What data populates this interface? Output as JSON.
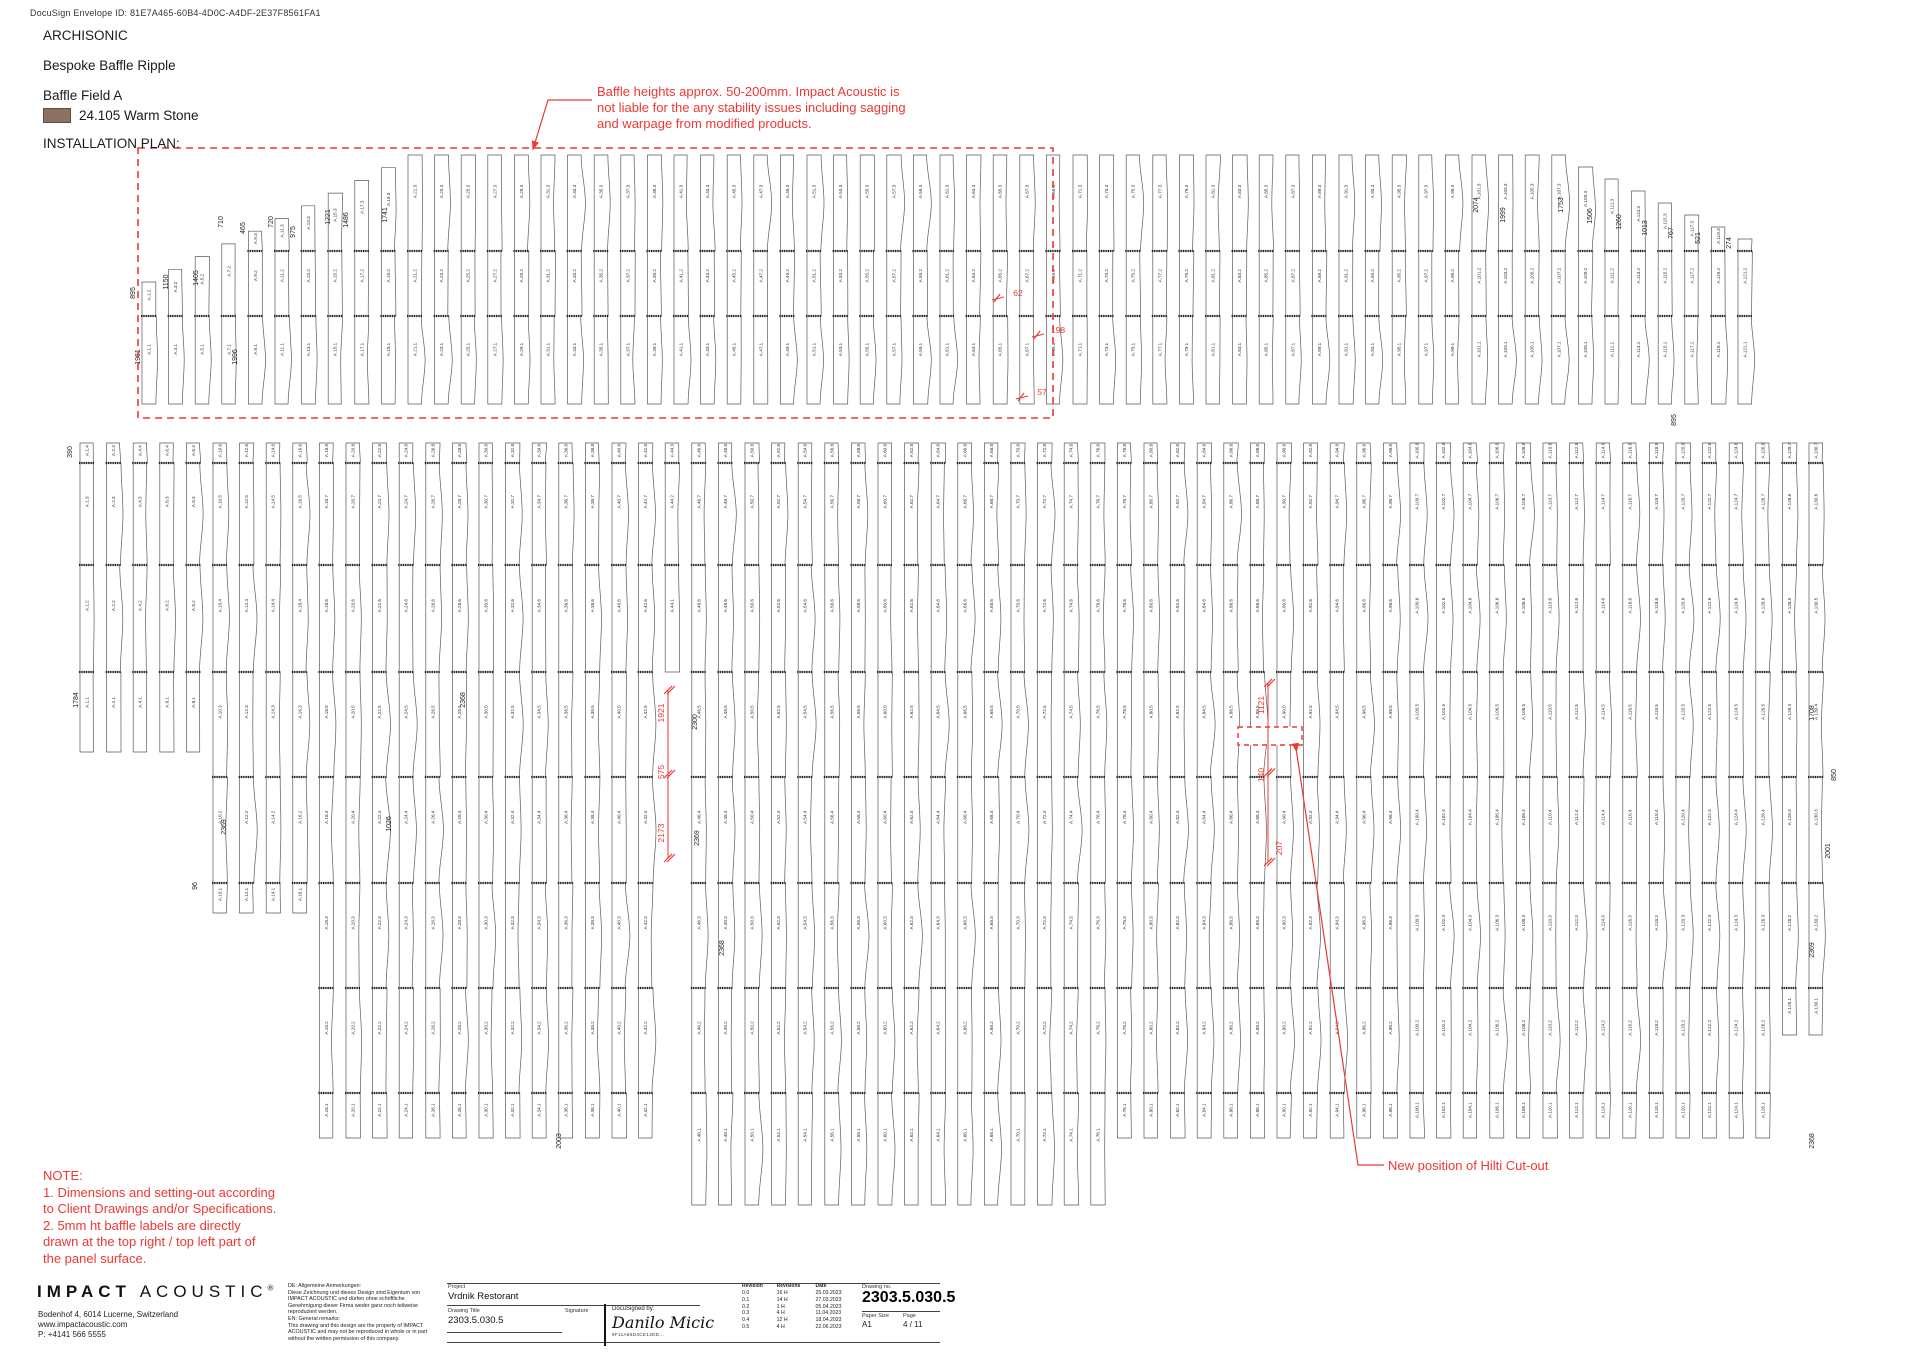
{
  "docusign_line": "DocuSign Envelope ID: 81E7A465-60B4-4D0C-A4DF-2E37F8561FA1",
  "header": {
    "brand": "ARCHISONIC",
    "product": "Bespoke Baffle Ripple",
    "field": "Baffle Field A",
    "material": "24.105 Warm Stone",
    "material_swatch_color": "#8b7160",
    "plan_label": "INSTALLATION PLAN:"
  },
  "annotations": {
    "red_color": "#ed3833",
    "baffle_note_line1": "Baffle heights approx. 50-200mm. Impact Acoustic is",
    "baffle_note_line2": "not liable for the any stability issues including sagging",
    "baffle_note_line3": "and warpage from modified products.",
    "hilti_note": "New position of Hilti Cut-out",
    "note_title": "NOTE:",
    "note_line1": "1. Dimensions and setting-out according",
    "note_line2": "to Client Drawings and/or Specifications.",
    "note_line3": "2. 5mm ht baffle labels are directly",
    "note_line4": "drawn at the top right / top left part of",
    "note_line5": "the panel surface."
  },
  "title_block": {
    "logo_bold": "IMPACT",
    "logo_light": "ACOUSTIC",
    "logo_reg": "®",
    "address_line1": "Bodenhof 4, 6014 Lucerne, Switzerland",
    "address_line2": "www.impactacoustic.com",
    "address_line3": "P: +4141 566 5555",
    "remarks_line1": "DE: Allgemeine Anmerkungen:",
    "remarks_line2": "Diese Zeichnung und dieses Design sind Eigentum von",
    "remarks_line3": "IMPACT ACOUSTIC und dürfen ohne schriftliche",
    "remarks_line4": "Genehmigung dieser Firma weder ganz noch teilweise",
    "remarks_line5": "reproduziert werden.",
    "remarks_line6": "EN: General remarks:",
    "remarks_line7": "This drawing and this design are the property of IMPACT",
    "remarks_line8": "ACOUSTIC and may not be reproduced in whole or in part",
    "remarks_line9": "without the written permission of this company.",
    "project_label": "Project",
    "project_value": "Vrdnik Restorant",
    "drawing_title_label": "Drawing Title",
    "drawing_title_value": "2303.5.030.5",
    "signature_label": "Signature",
    "docusigned_label": "DocuSigned by:",
    "docusigned_name": "Danilo Micic",
    "docusigned_id": "9F11A86D4CE14DD...",
    "revisions": {
      "headers": [
        "Revision",
        "Revisions",
        "Date"
      ],
      "rows": [
        [
          "0.0",
          "16 H",
          "25.03.2023"
        ],
        [
          "0.1",
          "14 H",
          "27.03.2023"
        ],
        [
          "0.2",
          "1 H",
          "05.04.2023"
        ],
        [
          "0.3",
          "4 H",
          "11.04.2023"
        ],
        [
          "0.4",
          "12 H",
          "18.04.2023"
        ],
        [
          "0.5",
          "4 H",
          "22.06.2023"
        ]
      ]
    },
    "drawing_no_label": "Drawing no.",
    "drawing_no_value": "2303.5.030.5",
    "paper_size_label": "Paper Size",
    "paper_size_value": "A1",
    "page_label": "Page",
    "page_value": "4 / 11"
  },
  "plan": {
    "label_prefix": "A",
    "stroke_color": "#5a5a5a",
    "label_color": "#333333",
    "red_color": "#ed3833",
    "bands": [
      {
        "seed": 11,
        "x0": 142,
        "pitch": 26.6,
        "cols": 61,
        "width": 13,
        "yTop": 155,
        "yBottom": 404,
        "splices": [
          251,
          316
        ],
        "stairLeft": {
          "count": 11,
          "startTop": 282,
          "step": 12.7
        },
        "stairRight": {
          "count": 7,
          "step": 12
        },
        "numbering": "odd"
      },
      {
        "seed": 29,
        "x0": 80,
        "pitch": 26.6,
        "cols": 66,
        "width": 13,
        "yTop": 443,
        "yBottom": 1138,
        "splices": [
          463,
          565,
          672,
          777,
          883,
          988,
          1093
        ],
        "depthRules": [
          {
            "from": 0,
            "to": 4,
            "bottom": 752
          },
          {
            "from": 5,
            "to": 8,
            "bottom": 913
          },
          {
            "centerX": [
              690,
              1110
            ],
            "bottom": 1205
          },
          {
            "from": 64,
            "to": 65,
            "bottom": 1035
          }
        ],
        "gapCols": [
          22
        ],
        "gapAt": 672,
        "numbering": "evenFromOne"
      }
    ],
    "red_overlays": {
      "dash_rect_field": {
        "x": 138,
        "y": 148,
        "w": 915,
        "h": 270
      },
      "dash_rect_cutout": {
        "x": 1238,
        "y": 727,
        "w": 64,
        "h": 18
      },
      "note_leader": [
        [
          592,
          100
        ],
        [
          548,
          100
        ],
        [
          534,
          146
        ]
      ],
      "hilti_leader": [
        [
          1296,
          748
        ],
        [
          1358,
          1165
        ],
        [
          1384,
          1165
        ]
      ],
      "dim_line_mid": {
        "x": 668,
        "y1": 690,
        "y2": 858
      },
      "dim_line_cut": {
        "x": 1268,
        "y1": 683,
        "y2": 862
      }
    },
    "red_dims": [
      {
        "v": "62",
        "x": 1018,
        "y": 296,
        "rot": false
      },
      {
        "v": "198",
        "x": 1058,
        "y": 333,
        "rot": false
      },
      {
        "v": "57",
        "x": 1042,
        "y": 395,
        "rot": false
      },
      {
        "v": "1921",
        "x": 664,
        "y": 713,
        "rot": true
      },
      {
        "v": "575",
        "x": 664,
        "y": 772,
        "rot": true
      },
      {
        "v": "2173",
        "x": 664,
        "y": 833,
        "rot": true
      },
      {
        "v": "1121",
        "x": 1264,
        "y": 705,
        "rot": true
      },
      {
        "v": "140",
        "x": 1264,
        "y": 775,
        "rot": true
      },
      {
        "v": "207",
        "x": 1282,
        "y": 848,
        "rot": true
      }
    ],
    "black_dims": [
      {
        "v": "895",
        "x": 135,
        "y": 293
      },
      {
        "v": "1150",
        "x": 168,
        "y": 282
      },
      {
        "v": "1405",
        "x": 198,
        "y": 278
      },
      {
        "v": "465",
        "x": 245,
        "y": 228
      },
      {
        "v": "710",
        "x": 223,
        "y": 222
      },
      {
        "v": "720",
        "x": 273,
        "y": 222
      },
      {
        "v": "975",
        "x": 295,
        "y": 232
      },
      {
        "v": "1221",
        "x": 330,
        "y": 217
      },
      {
        "v": "1486",
        "x": 348,
        "y": 220
      },
      {
        "v": "1741",
        "x": 387,
        "y": 215
      },
      {
        "v": "1961",
        "x": 140,
        "y": 357
      },
      {
        "v": "1996",
        "x": 237,
        "y": 357
      },
      {
        "v": "2074",
        "x": 1478,
        "y": 205
      },
      {
        "v": "1999",
        "x": 1505,
        "y": 215
      },
      {
        "v": "1753",
        "x": 1563,
        "y": 205
      },
      {
        "v": "1506",
        "x": 1592,
        "y": 216
      },
      {
        "v": "1260",
        "x": 1621,
        "y": 222
      },
      {
        "v": "1013",
        "x": 1647,
        "y": 228
      },
      {
        "v": "767",
        "x": 1673,
        "y": 233
      },
      {
        "v": "521",
        "x": 1700,
        "y": 238
      },
      {
        "v": "274",
        "x": 1731,
        "y": 243
      },
      {
        "v": "895",
        "x": 1676,
        "y": 420
      },
      {
        "v": "390",
        "x": 72,
        "y": 452
      },
      {
        "v": "1784",
        "x": 78,
        "y": 700
      },
      {
        "v": "2369",
        "x": 226,
        "y": 827
      },
      {
        "v": "96",
        "x": 197,
        "y": 886
      },
      {
        "v": "2300",
        "x": 697,
        "y": 722
      },
      {
        "v": "2369",
        "x": 699,
        "y": 838
      },
      {
        "v": "1026",
        "x": 391,
        "y": 824
      },
      {
        "v": "2368",
        "x": 724,
        "y": 948
      },
      {
        "v": "1708",
        "x": 1814,
        "y": 713
      },
      {
        "v": "850",
        "x": 1836,
        "y": 775
      },
      {
        "v": "2001",
        "x": 1830,
        "y": 851
      },
      {
        "v": "2369",
        "x": 1814,
        "y": 950
      },
      {
        "v": "2368",
        "x": 1814,
        "y": 1141
      },
      {
        "v": "2003",
        "x": 561,
        "y": 1141
      },
      {
        "v": "2368",
        "x": 465,
        "y": 700
      }
    ]
  }
}
